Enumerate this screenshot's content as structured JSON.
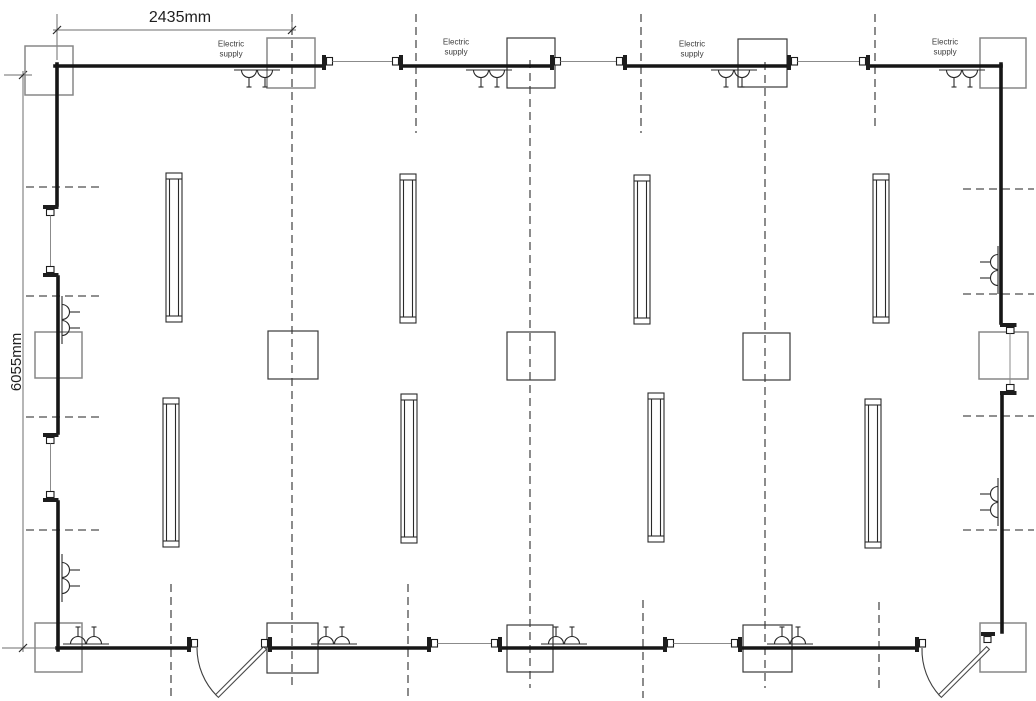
{
  "texts": {
    "width_dim": "2435mm",
    "height_dim": "6055mm",
    "supply_line1": "Electric",
    "supply_line2": "supply"
  },
  "colors": {
    "cable": "#161616",
    "thin_link": "#8b8b8b",
    "dashed": "#4d4d4d",
    "box_grey": "#878787",
    "box_dark": "#3a3a3a",
    "text": "#1f1f1f"
  },
  "canvas": {
    "w": 1036,
    "h": 701
  },
  "supply_labels": [
    {
      "x": 231,
      "y1": 46.5,
      "y2": 56
    },
    {
      "x": 456,
      "y1": 44.5,
      "y2": 54
    },
    {
      "x": 692,
      "y1": 46.5,
      "y2": 56
    },
    {
      "x": 945,
      "y1": 44.5,
      "y2": 54
    }
  ],
  "cable_segments": [
    [
      55,
      66,
      322,
      66
    ],
    [
      403,
      66,
      550,
      66
    ],
    [
      627,
      66,
      787,
      66
    ],
    [
      870,
      66,
      1001,
      66
    ],
    [
      1001,
      64,
      1001,
      323
    ],
    [
      1002,
      395,
      1002,
      632
    ],
    [
      57,
      64,
      57,
      205
    ],
    [
      58,
      277,
      58,
      433
    ],
    [
      58,
      502,
      58,
      650
    ],
    [
      57,
      648,
      187,
      648
    ],
    [
      272,
      648,
      427,
      648
    ],
    [
      502,
      648,
      663,
      648
    ],
    [
      742,
      648,
      915,
      648
    ]
  ],
  "couplers_horizontal": [
    {
      "a": 322,
      "b": 403,
      "y": 66,
      "link": true,
      "right_side": true
    },
    {
      "a": 550,
      "b": 627,
      "y": 66,
      "link": true,
      "right_side": true
    },
    {
      "a": 787,
      "b": 870,
      "y": 66,
      "link": true,
      "right_side": true
    },
    {
      "a": 427,
      "b": 502,
      "y": 648,
      "link": true,
      "right_side": true
    },
    {
      "a": 663,
      "b": 742,
      "y": 648,
      "link": true,
      "right_side": true
    },
    {
      "a": 187,
      "b": 272,
      "y": 648,
      "link": false,
      "right_side": true
    },
    {
      "a": 915,
      "b": 990,
      "y": 648,
      "link": false,
      "right_side": false
    }
  ],
  "couplers_left_wall": [
    {
      "a": 205,
      "b": 277
    },
    {
      "a": 433,
      "b": 502
    }
  ],
  "couplers_right_wall": [
    {
      "a": 323,
      "b": 395
    }
  ],
  "door_hinge_coupler": {
    "bar": [
      981,
      632,
      14,
      4
    ],
    "nub": [
      984,
      636.5,
      7,
      6
    ]
  },
  "boxes": [
    {
      "x": 25,
      "y": 46,
      "w": 48,
      "h": 49,
      "tone": "grey"
    },
    {
      "x": 267,
      "y": 38,
      "w": 48,
      "h": 50,
      "tone": "grey"
    },
    {
      "x": 507,
      "y": 38,
      "w": 48,
      "h": 50,
      "tone": "dark"
    },
    {
      "x": 738,
      "y": 39,
      "w": 49,
      "h": 48,
      "tone": "dark"
    },
    {
      "x": 980,
      "y": 38,
      "w": 46,
      "h": 50,
      "tone": "grey"
    },
    {
      "x": 35,
      "y": 332,
      "w": 47,
      "h": 46,
      "tone": "grey"
    },
    {
      "x": 268,
      "y": 331,
      "w": 50,
      "h": 48,
      "tone": "dark"
    },
    {
      "x": 507,
      "y": 332,
      "w": 48,
      "h": 48,
      "tone": "dark"
    },
    {
      "x": 743,
      "y": 333,
      "w": 47,
      "h": 47,
      "tone": "dark"
    },
    {
      "x": 979,
      "y": 332,
      "w": 49,
      "h": 47,
      "tone": "grey"
    },
    {
      "x": 35,
      "y": 623,
      "w": 47,
      "h": 49,
      "tone": "grey"
    },
    {
      "x": 267,
      "y": 623,
      "w": 51,
      "h": 50,
      "tone": "dark"
    },
    {
      "x": 507,
      "y": 625,
      "w": 46,
      "h": 47,
      "tone": "dark"
    },
    {
      "x": 743,
      "y": 625,
      "w": 49,
      "h": 47,
      "tone": "dark"
    },
    {
      "x": 980,
      "y": 623,
      "w": 46,
      "h": 49,
      "tone": "grey"
    }
  ],
  "fixture_size": {
    "w": 16,
    "h": 149
  },
  "fixtures": [
    {
      "x": 166,
      "y": 173
    },
    {
      "x": 400,
      "y": 174
    },
    {
      "x": 634,
      "y": 175
    },
    {
      "x": 873,
      "y": 174
    },
    {
      "x": 163,
      "y": 398
    },
    {
      "x": 401,
      "y": 394
    },
    {
      "x": 648,
      "y": 393
    },
    {
      "x": 865,
      "y": 399
    }
  ],
  "lights": {
    "top": [
      257,
      489,
      734,
      962
    ],
    "bottom": [
      86,
      334,
      564,
      790
    ],
    "left": [
      320,
      578
    ],
    "right": [
      270,
      502
    ]
  },
  "dashed_vertical": [
    [
      292,
      14,
      688
    ],
    [
      530,
      60,
      688
    ],
    [
      765,
      62,
      688
    ],
    [
      416,
      14,
      133
    ],
    [
      641,
      14,
      133
    ],
    [
      875,
      14,
      126
    ],
    [
      171,
      584,
      700
    ],
    [
      408,
      584,
      700
    ],
    [
      643,
      600,
      698
    ],
    [
      879,
      602,
      692
    ]
  ],
  "dashed_horizontal_left": {
    "x1": 26,
    "x2": 100,
    "ys": [
      187,
      296,
      417,
      530
    ]
  },
  "dashed_horizontal_right": {
    "x1": 963,
    "x2": 1034,
    "ys": [
      189,
      294,
      416,
      530
    ]
  },
  "doors": [
    {
      "arc": "M 197 648 A 68 68 0 0 0 217 696",
      "leaf": "266.4,649.4 263.6,646.6 215.6,694.6 218.4,697.4"
    },
    {
      "arc": "M 922 648 A 68 68 0 0 0 940 696",
      "leaf": "989.4,649.4 986.6,646.6 938.6,694.6 941.4,697.4"
    }
  ],
  "dim_width": {
    "line": [
      53,
      30,
      296,
      30
    ],
    "ext": [
      [
        57,
        14,
        57,
        60
      ],
      [
        292,
        14,
        292,
        30
      ]
    ],
    "ticks": [
      [
        53,
        34,
        61,
        26
      ],
      [
        288,
        34,
        296,
        26
      ]
    ],
    "label_x": 180,
    "label_y": 22
  },
  "dim_height": {
    "line": [
      23,
      71,
      23,
      652
    ],
    "ext": [
      [
        4,
        75,
        32,
        75
      ],
      [
        2,
        648,
        55,
        648
      ]
    ],
    "ticks": [
      [
        19,
        79,
        27,
        71
      ],
      [
        19,
        652,
        27,
        644
      ]
    ],
    "label_x": 16,
    "label_y": 362
  }
}
